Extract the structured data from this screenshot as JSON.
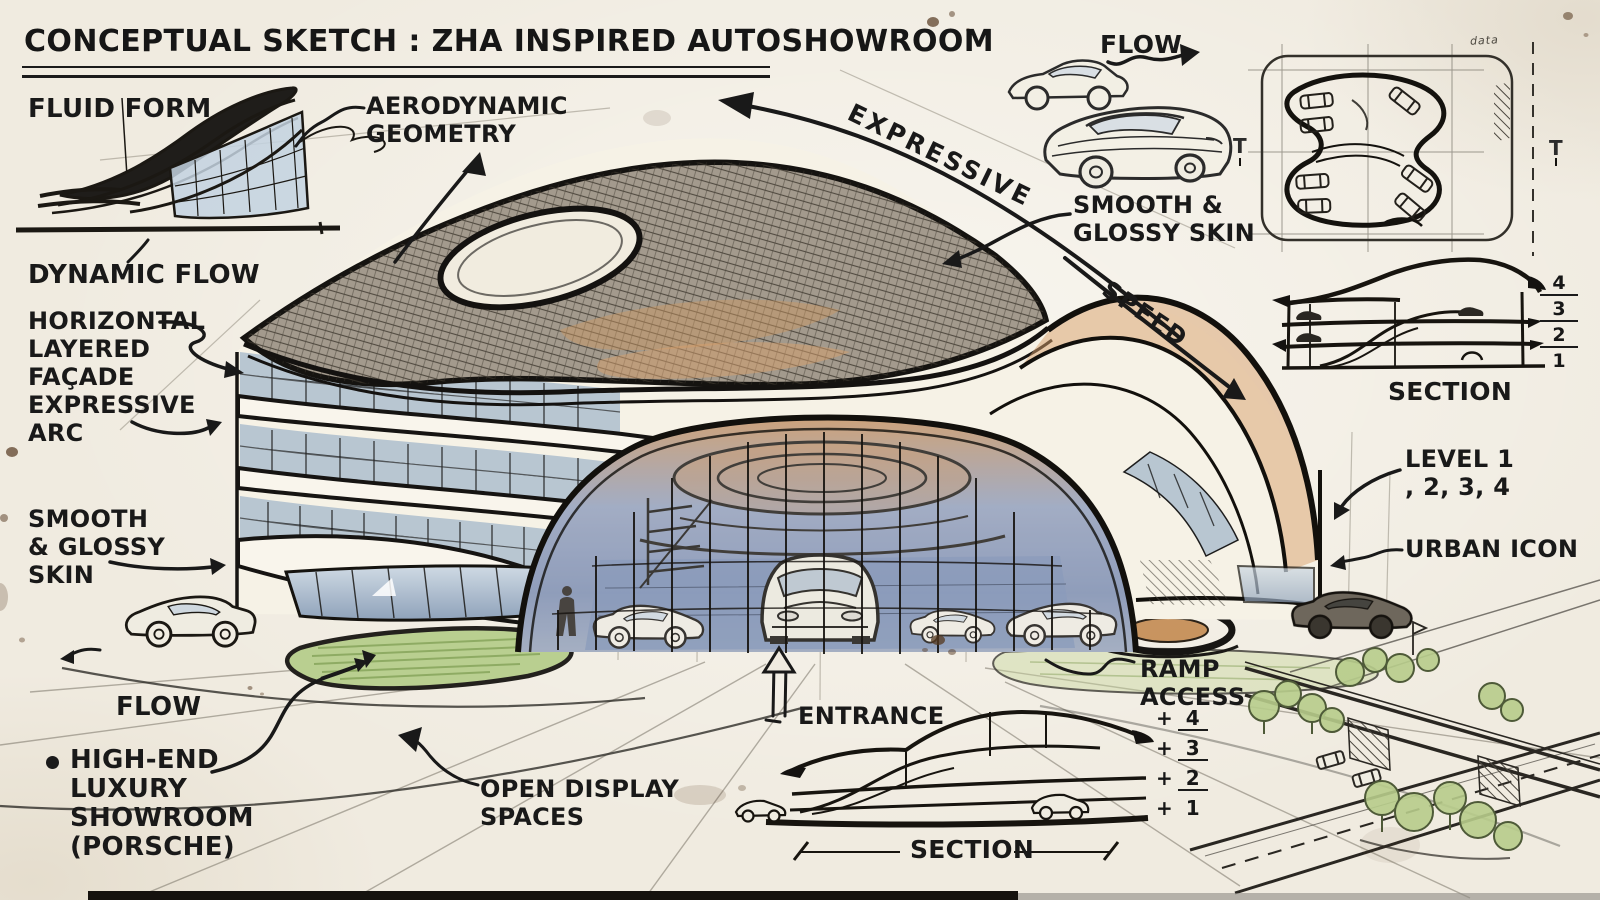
{
  "title": "CONCEPTUAL SKETCH : ZHA INSPIRED AUTOSHOWROOM",
  "bullet": "●",
  "labels": {
    "fluid_form": "FLUID FORM",
    "aerodynamic_geometry": "AERODYNAMIC\nGEOMETRY",
    "dynamic_flow": "DYNAMIC FLOW",
    "horizontal_layered_facade": "HORIZONTAL\nLAYERED\nFAÇADE",
    "expressive_arc": "EXPRESSIVE\nARC",
    "smooth_glossy_skin_left": "SMOOTH\n& GLOSSY\nSKIN",
    "flow_left": "FLOW",
    "high_end_luxury": "HIGH-END\nLUXURY\nSHOWROOM\n(PORSCHE)",
    "open_display_spaces": "OPEN DISPLAY\nSPACES",
    "entrance": "ENTRANCE",
    "expressive": "EXPRESSIVE",
    "flow_right": "FLOW",
    "smooth_glossy_skin_right": "SMOOTH &\nGLOSSY SKIN",
    "speed": "SPEED",
    "level_1234": "LEVEL 1\n, 2, 3, 4",
    "urban_icon": "URBAN ICON",
    "ramp_access": "RAMP\nACCESS"
  },
  "right_section": {
    "title": "SECTION",
    "levels": [
      "4",
      "3",
      "2",
      "1"
    ]
  },
  "bottom_section": {
    "title": "SECTION",
    "levels": [
      "4",
      "3",
      "2",
      "1"
    ],
    "plus_sign": "+"
  },
  "plan_view": {
    "scribble": "data",
    "t_marker_left": "T",
    "t_marker_right": "T"
  },
  "palette": {
    "paper": "#f0ebe0",
    "ink": "#1b1b1b",
    "glazing_blue": "#a9bacc",
    "interior_blue": "#7b8fb3",
    "accent_tan": "#d8a06c",
    "lawn_green": "#b9cf90",
    "tree_green": "#b7cc8b",
    "shell_gray": "#a39a8d"
  }
}
